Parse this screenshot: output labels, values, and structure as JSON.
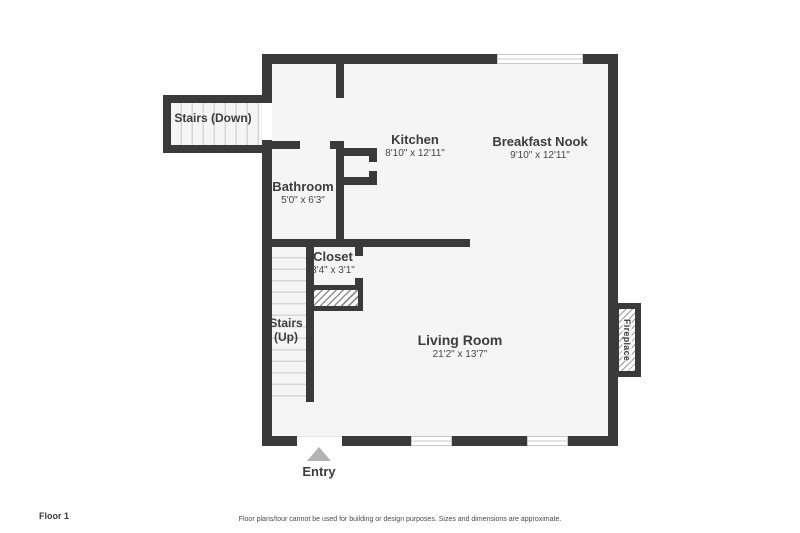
{
  "title": "Floor plan - Floor 1",
  "colors": {
    "wall": "#3a3a3a",
    "floor": "#f5f5f5",
    "tread": "#d6d6d6",
    "label": "#3d3d3d",
    "entry_arrow": "#b3b3b3",
    "window_line": "#c9c9c9",
    "muted": "#4a4a4a"
  },
  "rooms": {
    "stairs_down": {
      "name": "Stairs (Down)"
    },
    "kitchen": {
      "name": "Kitchen",
      "dims": "8'10\" x 12'11\""
    },
    "breakfast_nook": {
      "name": "Breakfast Nook",
      "dims": "9'10\" x 12'11\""
    },
    "bathroom": {
      "name": "Bathroom",
      "dims": "5'0\" x 6'3\""
    },
    "closet": {
      "name": "Closet",
      "dims": "3'4\" x 3'1\""
    },
    "stairs_up": {
      "name_line1": "Stairs",
      "name_line2": "(Up)"
    },
    "living_room": {
      "name": "Living Room",
      "dims": "21'2\" x 13'7\""
    },
    "fireplace": {
      "name": "Fireplace"
    }
  },
  "entry": {
    "label": "Entry"
  },
  "footer": {
    "floor_label": "Floor 1",
    "disclaimer": "Floor plans/tour cannot be used for building or design purposes. Sizes and dimensions are approximate."
  }
}
